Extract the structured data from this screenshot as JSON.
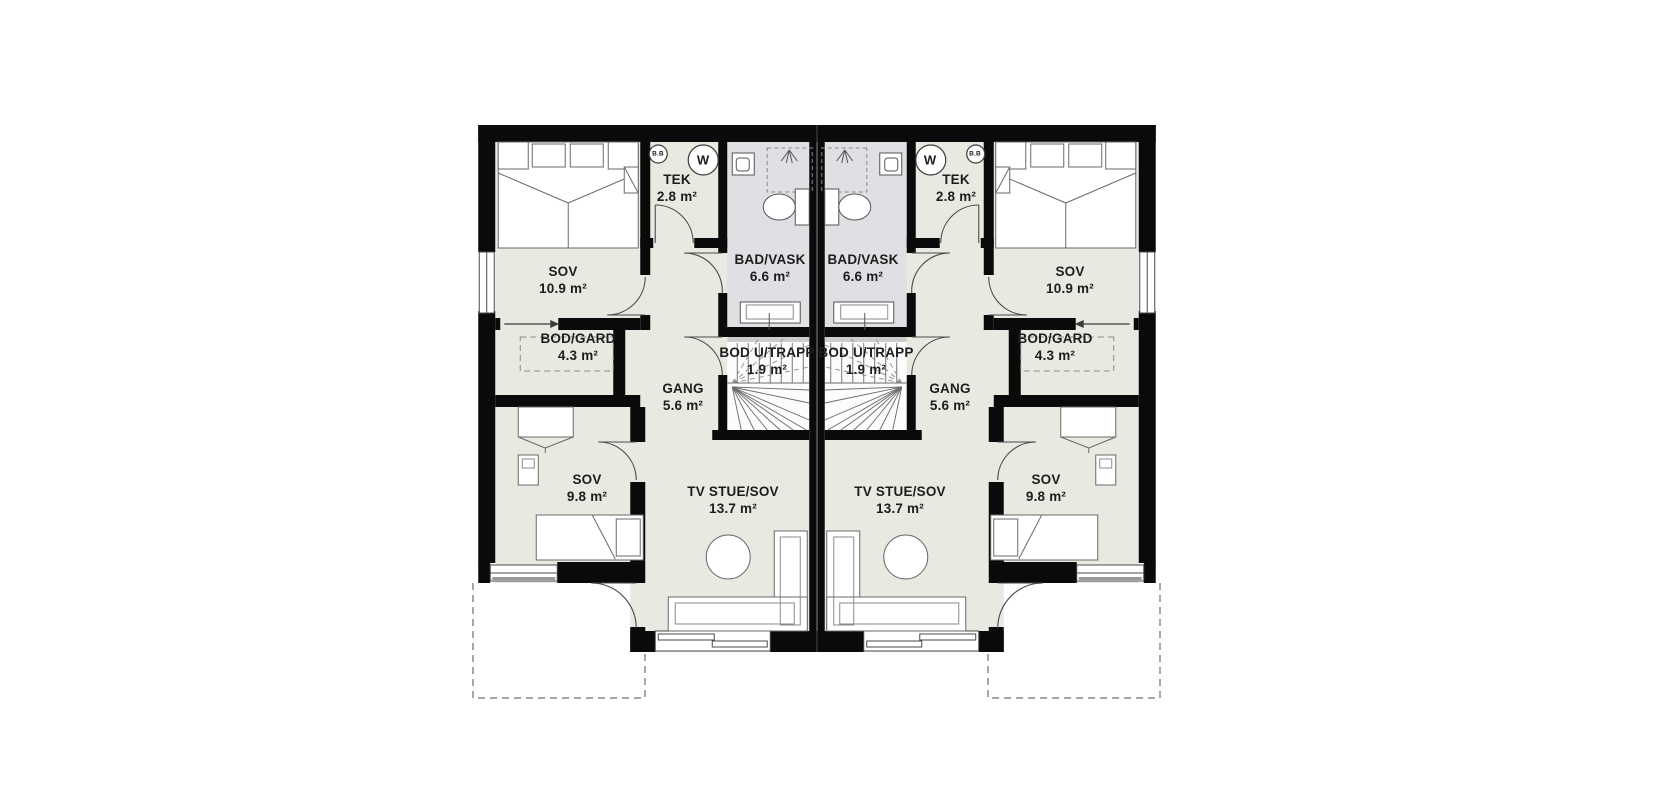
{
  "plan": {
    "rooms": {
      "sov_main": {
        "name": "SOV",
        "area": "10.9 m²"
      },
      "tek": {
        "name": "TEK",
        "area": "2.8 m²"
      },
      "bad_vask": {
        "name": "BAD/VASK",
        "area": "6.6 m²"
      },
      "bod_gard": {
        "name": "BOD/GARD",
        "area": "4.3 m²"
      },
      "bod_u_trapp": {
        "name": "BOD U/TRAPP",
        "area": "1.9 m²"
      },
      "gang": {
        "name": "GANG",
        "area": "5.6 m²"
      },
      "sov_small": {
        "name": "SOV",
        "area": "9.8 m²"
      },
      "tv_stue": {
        "name": "TV STUE/SOV",
        "area": "13.7 m²"
      }
    },
    "symbols": {
      "washing_machine": "W",
      "water_heater": "B.B"
    },
    "colors": {
      "wall": "#0a0a0a",
      "floor": "#e9e8e1",
      "bathroom_floor": "#dee0e3",
      "stairs_floor": "#fcfcfc",
      "furniture_line": "#6a6a6a",
      "dashed_line": "#8a8a8a"
    }
  }
}
